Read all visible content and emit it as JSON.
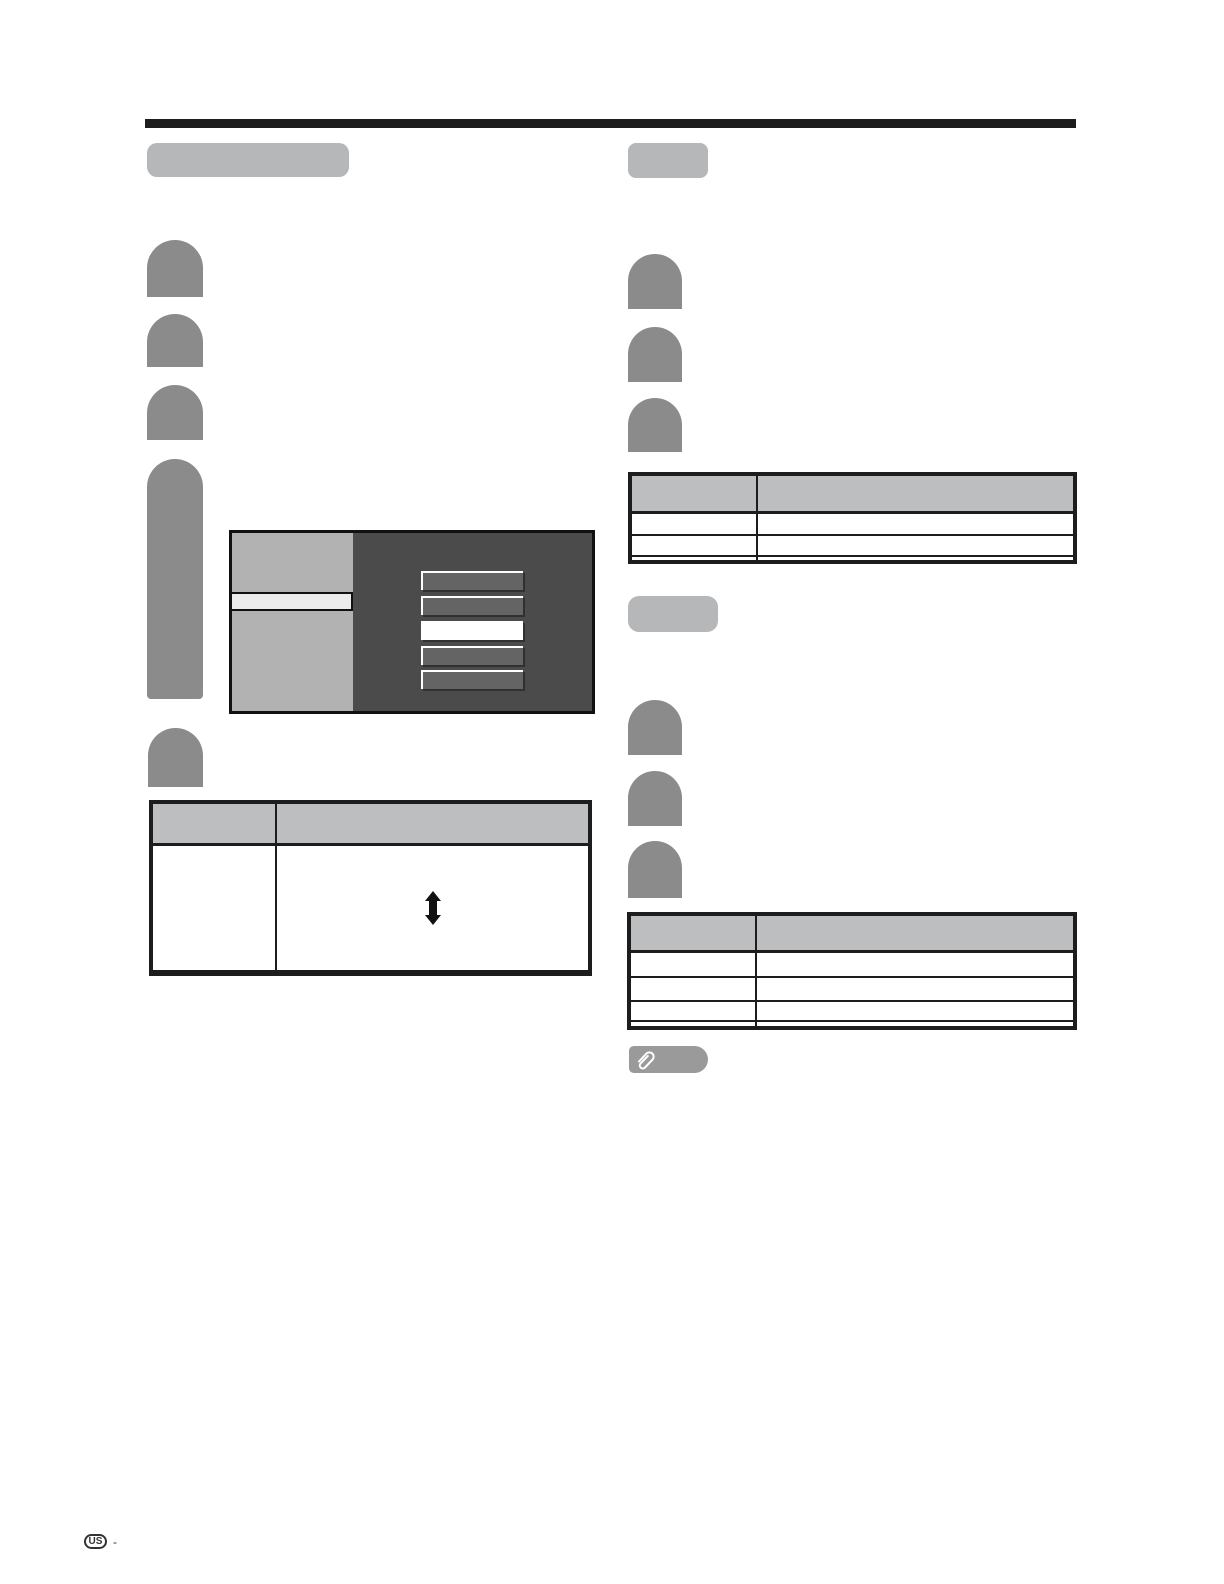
{
  "document": {
    "type": "scanned-manual-page",
    "description": "Faded instruction-manual page; body text is washed out, only layout graphics remain"
  },
  "footer": {
    "region_mark": "US",
    "separator": "-"
  },
  "icons": {
    "note_icon": "paperclip-icon",
    "adjust_icon": "up-down-arrow-icon"
  },
  "colors": {
    "page-bg": "#ffffff",
    "rule-black": "#1d1d1d",
    "pill-gray": "#b5b7b9",
    "step-gray": "#8b8b8b",
    "table-header-gray": "#bcbebf",
    "table-border": "#1d1d1d",
    "menu-panel-dark": "#4b4b4b",
    "menu-sidebar-gray": "#b2b2b2",
    "menu-highlight": "#ececec",
    "menu-button-gray": "#646464",
    "menu-button-selected": "#ffffff",
    "note-pill-gray": "#9a9a9a",
    "glyph-black": "#111111",
    "footer-ink": "#333333"
  },
  "osd_menu": {
    "button_count": 5,
    "selected_button_index": 2,
    "sidebar_highlight_row": 1
  },
  "left_table": {
    "columns": 2,
    "body_rows": 1
  },
  "right_table_1": {
    "columns": 2,
    "body_rows": 2
  },
  "right_table_2": {
    "columns": 2,
    "body_rows": 3
  }
}
